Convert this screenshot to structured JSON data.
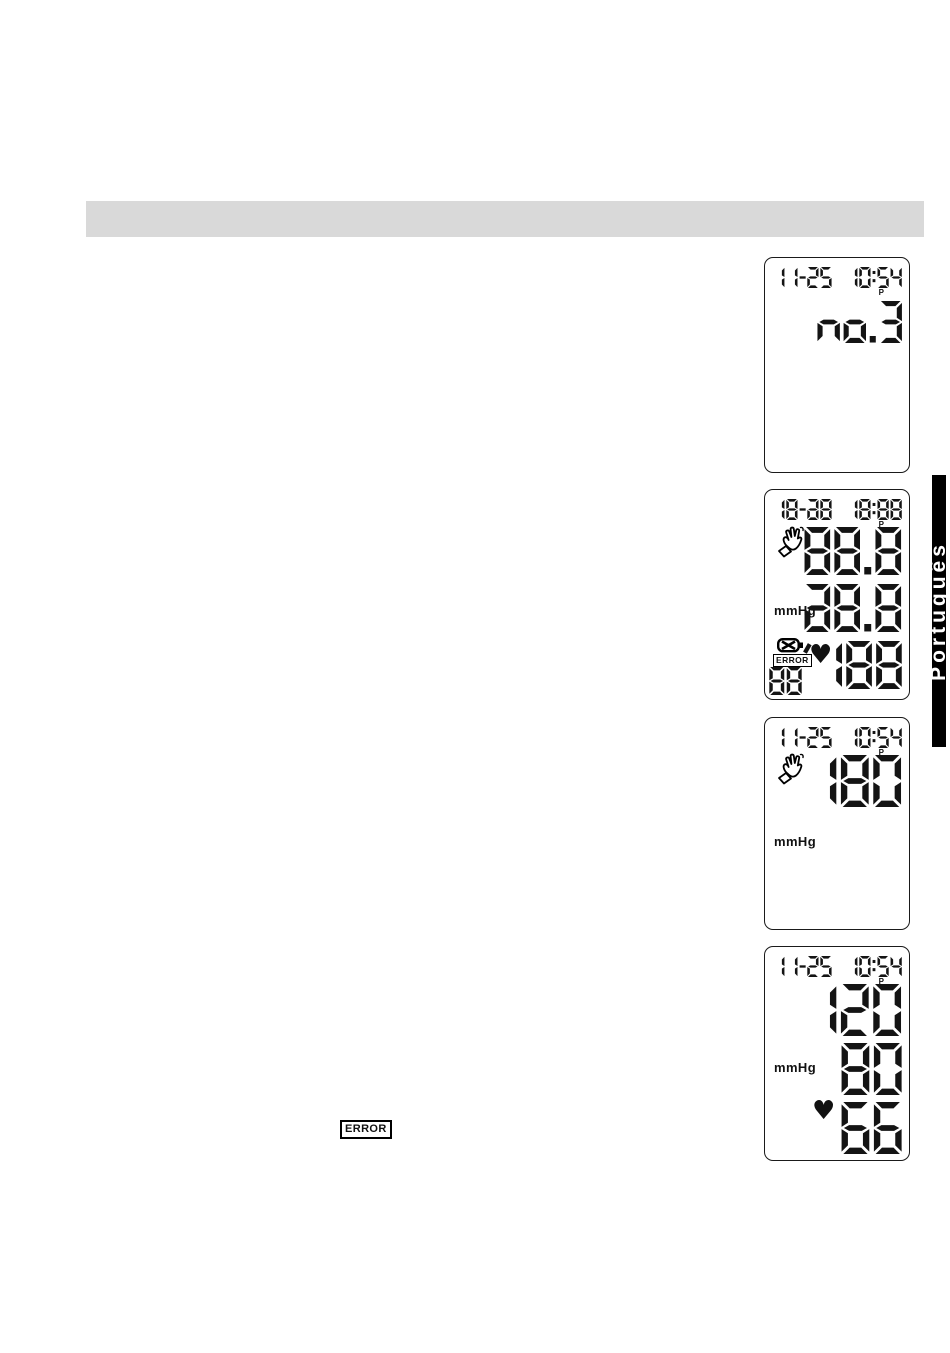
{
  "side_tab": {
    "label": "Português"
  },
  "body": {
    "error_badge": "ERROR"
  },
  "lcd_panels": {
    "memory_recall": {
      "date": "11-25",
      "time": "10:54",
      "meridiem": "P",
      "memory_label": "no.3"
    },
    "segment_test": {
      "date": "18-a8",
      "time": "18:88",
      "meridiem": "P",
      "systolic": "88.8",
      "diastolic": "a8.8",
      "pulse": "'188",
      "memory_count": "88",
      "unit": "mmHg",
      "error_badge": "ERROR",
      "heart_glyph": "♥"
    },
    "inflation": {
      "date": "11-25",
      "time": "10:54",
      "meridiem": "P",
      "pressure": "180",
      "unit": "mmHg"
    },
    "measurement_result": {
      "date": "11-25",
      "time": "10:54",
      "meridiem": "P",
      "systolic": "120",
      "diastolic": "80",
      "pulse": "66",
      "unit": "mmHg",
      "heart_glyph": "♥"
    }
  }
}
